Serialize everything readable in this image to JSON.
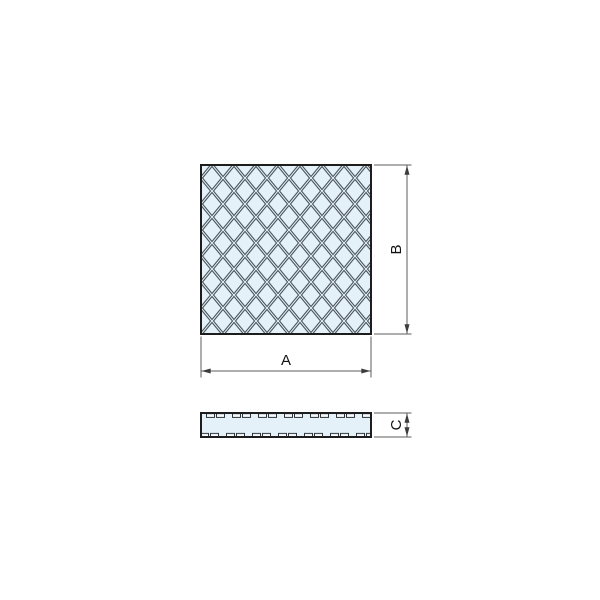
{
  "drawing": {
    "labels": {
      "a": "A",
      "b": "B",
      "c": "C"
    },
    "colors": {
      "background": "#ffffff",
      "pad_fill": "#e5f1f9",
      "tread_line": "#4b555c",
      "outline": "#1d1d1d",
      "dimension_line": "#5e5e5e",
      "arrow": "#3c3c3c",
      "label_text": "#111111",
      "rib_fill": "#f6fafd"
    }
  }
}
